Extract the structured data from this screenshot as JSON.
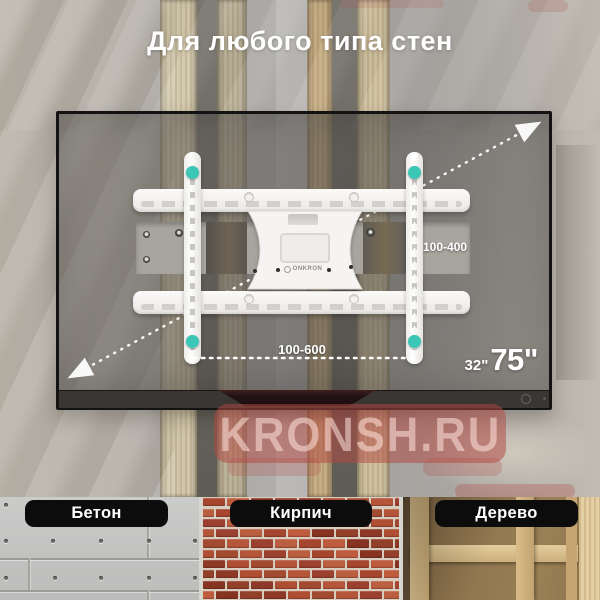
{
  "title": "Для любого типа стен",
  "tv": {
    "size_min": "32\"",
    "size_max": "75\""
  },
  "mount": {
    "brand": "ONKRON",
    "width_range_mm": "100-600",
    "height_range_mm": "100-400"
  },
  "watermark": {
    "text": "KRONSH.RU"
  },
  "wall_types": [
    {
      "label": "Бетон"
    },
    {
      "label": "Кирпич"
    },
    {
      "label": "Дерево"
    }
  ],
  "colors": {
    "accent_teal": "#3cc6b6",
    "watermark_red": "#b24842",
    "label_bg": "#0c0c0c",
    "annotation_white": "#ffffff"
  }
}
